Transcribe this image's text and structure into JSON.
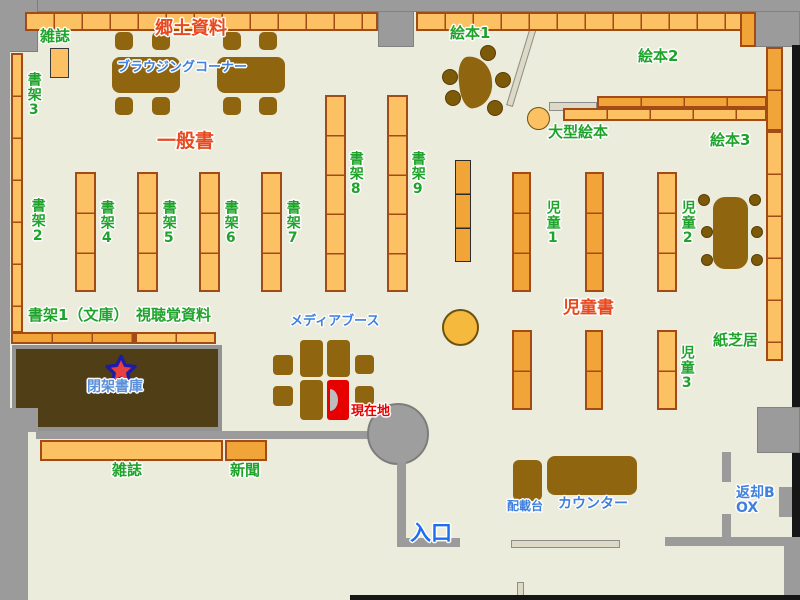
{
  "title": "library-floor-map",
  "labels": {
    "magazines_top": "雑誌",
    "local_materials": "郷土資料",
    "browsing_corner": "ブラウジングコーナー",
    "general_books": "一般書",
    "shelf2": "書架2",
    "shelf3": "書架3",
    "shelf4": "書架4",
    "shelf5": "書架5",
    "shelf6": "書架6",
    "shelf7": "書架7",
    "shelf8": "書架8",
    "shelf9": "書架9",
    "picture_books_1": "絵本1",
    "picture_books_2": "絵本2",
    "picture_books_3": "絵本3",
    "large_picture_books": "大型絵本",
    "children_1": "児童1",
    "children_2": "児童2",
    "children_3": "児童3",
    "children_books": "児童書",
    "kamishibai": "紙芝居",
    "shelf1_bunko": "書架1（文庫）",
    "audiovisual": "視聴覚資料",
    "closed_stacks": "閉架書庫",
    "media_booth": "メディアブース",
    "current_location": "現在地",
    "magazines_bottom": "雑誌",
    "newspapers": "新聞",
    "distribution_table": "配載台",
    "counter": "カウンター",
    "entrance": "入口",
    "return_box": "返却BOX"
  },
  "icons": {
    "closed_stacks_marker": "star-icon"
  },
  "colors": {
    "floor": "#ebecdc",
    "wall_gray": "#9b9b9b",
    "shelf_light": "#fbc163",
    "shelf_dark": "#f1a437",
    "shelf_border": "#a34b16",
    "furniture_brown": "#8f6510",
    "closed_stacks_brown": "#4f3e16",
    "label_green": "#1fa32b",
    "label_red": "#e8491f",
    "label_blue": "#3f7fde",
    "current_location_red": "#e60000",
    "star_fill": "#e8403c",
    "star_stroke": "#1c1ca8"
  }
}
